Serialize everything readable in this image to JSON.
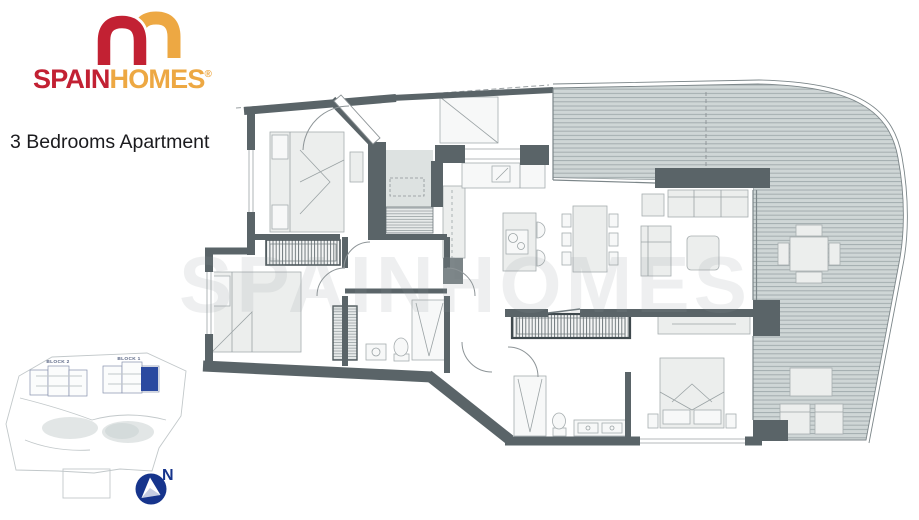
{
  "brand": {
    "name_primary": "SPAIN",
    "name_secondary": "HOMES",
    "registered_mark": "®"
  },
  "page": {
    "title": "3 Bedrooms Apartment",
    "watermark": "SPAINHOMES"
  },
  "site_plan": {
    "block_2_label": "BLOCK 2",
    "block_1_label": "BLOCK 1"
  },
  "compass": {
    "north_label": "N"
  },
  "colors": {
    "brand_red": "#c22133",
    "brand_gold": "#eda843",
    "text_dark": "#1b1b1e",
    "wall_gray": "#5a6468",
    "deck_fill": "#cfd6d6",
    "deck_line": "#a3acae",
    "navy": "#16348c",
    "site_blue": "#2b4aa0",
    "furniture_fill": "#eceeed",
    "furniture_line": "#a6adaf",
    "glass_line": "#7c8689"
  }
}
